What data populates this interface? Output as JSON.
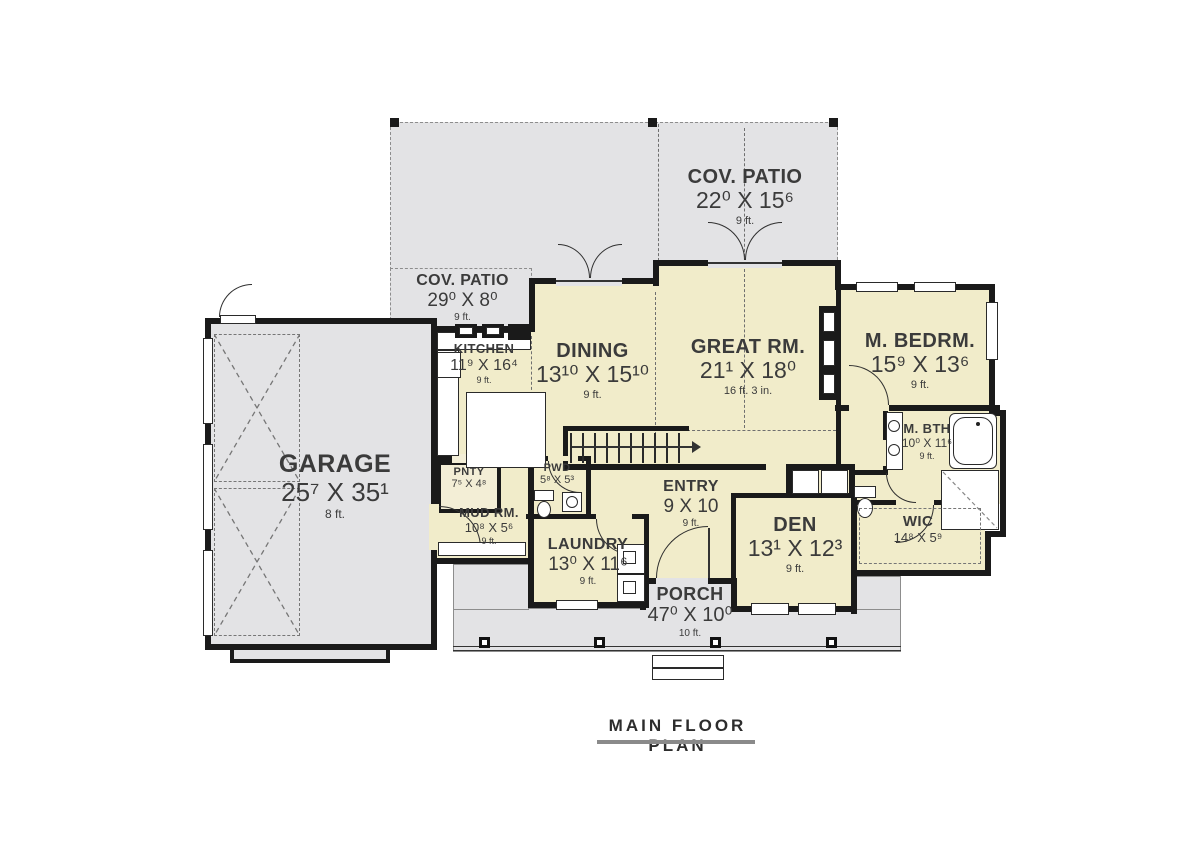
{
  "title": {
    "text": "MAIN FLOOR PLAN"
  },
  "colors": {
    "patio": "#e3e3e5",
    "room": "#f1ecca",
    "wall": "#1a1a1a",
    "text": "#3b3b3b"
  },
  "rooms": {
    "cov_patio_top": {
      "name": "COV. PATIO",
      "dims": "22⁰ X 15⁶",
      "height": "9 ft."
    },
    "cov_patio_left": {
      "name": "COV. PATIO",
      "dims": "29⁰ X 8⁰",
      "height": "9 ft."
    },
    "kitchen": {
      "name": "KITCHEN",
      "dims": "11⁹ X 16⁴",
      "height": "9 ft."
    },
    "dining": {
      "name": "DINING",
      "dims": "13¹⁰ X 15¹⁰",
      "height": "9 ft."
    },
    "great_rm": {
      "name": "GREAT RM.",
      "dims": "21¹ X 18⁰",
      "height": "16 ft. 3 in."
    },
    "m_bedrm": {
      "name": "M. BEDRM.",
      "dims": "15⁹ X 13⁶",
      "height": "9 ft."
    },
    "garage": {
      "name": "GARAGE",
      "dims": "25⁷ X 35¹",
      "height": "8 ft."
    },
    "pntry": {
      "name": "PNTY",
      "dims": "7⁵ X 4⁸"
    },
    "pwd": {
      "name": "PWD",
      "dims": "5⁸ X 5³"
    },
    "mud_rm": {
      "name": "MUD RM.",
      "dims": "10⁸ X 5⁶",
      "height": "9 ft."
    },
    "laundry": {
      "name": "LAUNDRY",
      "dims": "13⁰ X 11⁶",
      "height": "9 ft."
    },
    "entry": {
      "name": "ENTRY",
      "dims": "9 X 10",
      "height": "9 ft."
    },
    "den": {
      "name": "DEN",
      "dims": "13¹ X 12³",
      "height": "9 ft."
    },
    "m_bth": {
      "name": "M. BTH",
      "dims": "10⁰ X 11⁶",
      "height": "9 ft."
    },
    "wic": {
      "name": "WIC",
      "dims": "14⁸ X 5⁹"
    },
    "porch": {
      "name": "PORCH",
      "dims": "47⁰ X 10⁰",
      "height": "10 ft."
    }
  }
}
